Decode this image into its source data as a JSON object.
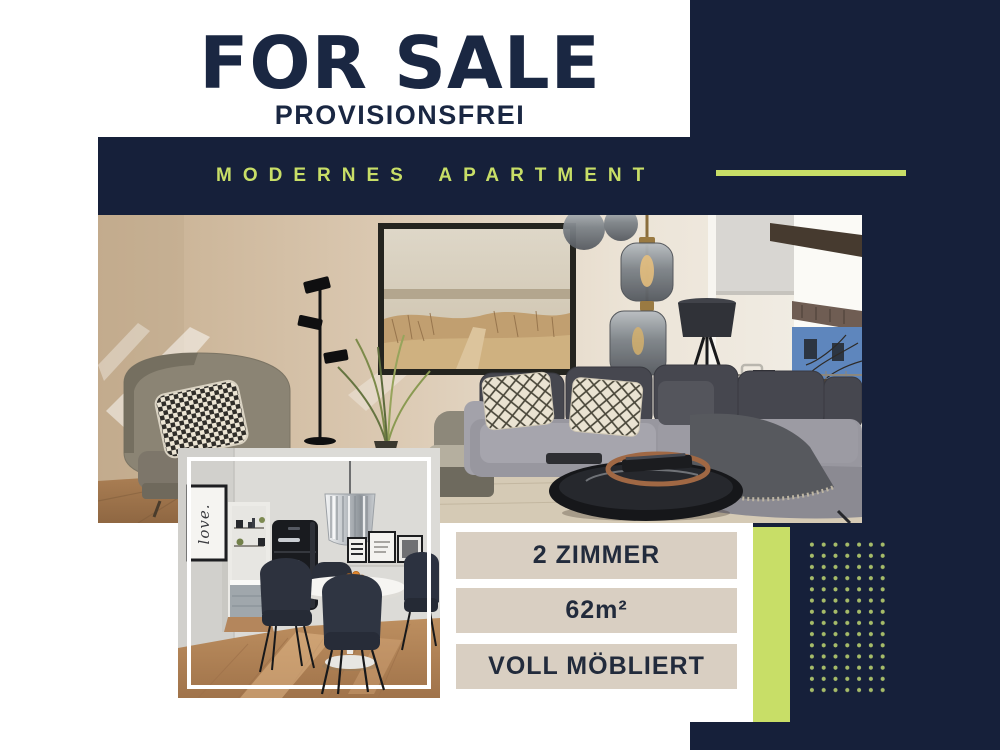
{
  "title": "FOR SALE",
  "subtitle": "PROVISIONSFREI",
  "banner": "MODERNES APARTMENT",
  "features": [
    "2 ZIMMER",
    "62m²",
    "VOLL MÖBLIERT"
  ],
  "photos": {
    "main": {
      "description": "Living room: grey corner sofa, dune wall art, smoked-glass pendant lamps, tripod floor lamp, wingback armchair, window with balcony view"
    },
    "small": {
      "description": "Dining area: round white table, dark chairs, black retro fridge, kitchen doorway",
      "sign_text": "love."
    }
  },
  "colors": {
    "navy": "#16203a",
    "lime": "#c8de67",
    "beige": "#d9cfc2",
    "heading_text": "#1a2742",
    "label_text": "#222b3c"
  }
}
